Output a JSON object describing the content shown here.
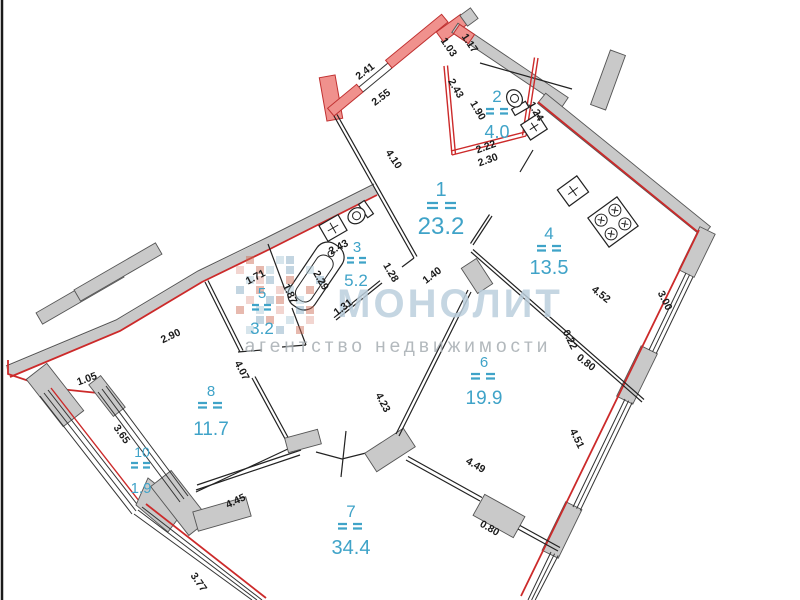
{
  "watermark": {
    "brand": "МОНОЛИТ",
    "tagline": "агентство недвижимости"
  },
  "rooms": [
    {
      "number": "1",
      "area": "23.2"
    },
    {
      "number": "2",
      "area": "4.0"
    },
    {
      "number": "3",
      "area": "5.2"
    },
    {
      "number": "4",
      "area": "13.5"
    },
    {
      "number": "5",
      "area": "3.2"
    },
    {
      "number": "6",
      "area": "19.9"
    },
    {
      "number": "7",
      "area": "34.4"
    },
    {
      "number": "8",
      "area": "11.7"
    },
    {
      "number": "10",
      "area": "1.9"
    }
  ],
  "dimensions": [
    "2.41",
    "2.55",
    "1.03",
    "1.17",
    "2.43",
    "1.90",
    "1.24",
    "2.22",
    "2.30",
    "4.10",
    "1.40",
    "2.43",
    "2.29",
    "1.31",
    "1.28",
    "1.87",
    "1.71",
    "2.90",
    "4.07",
    "1.05",
    "3.65",
    "4.45",
    "3.77",
    "4.23",
    "4.49",
    "0.80",
    "4.52",
    "3.00",
    "0.22",
    "0.80",
    "4.51"
  ],
  "icons": [
    "bathtub-icon",
    "toilet-icon",
    "sink-icon",
    "stove-icon"
  ],
  "colors": {
    "exterior_red": "#cc2a2a",
    "red_wall_fill": "#f0918d",
    "grey_wall_fill": "#c9c9c9",
    "room_label_blue": "#3fa3c8",
    "dimension_text": "#1a1a1a",
    "watermark_brand": "#bccfdd",
    "watermark_tagline": "#a6adb2"
  }
}
